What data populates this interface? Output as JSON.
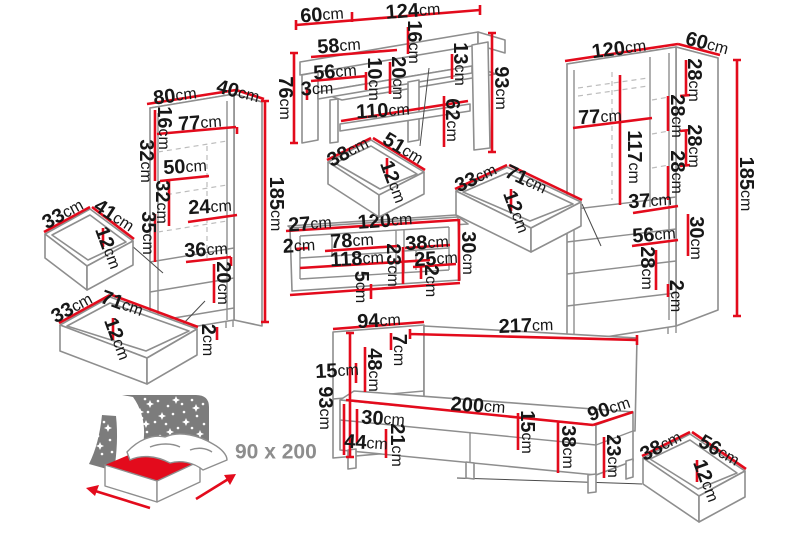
{
  "colors": {
    "dimension_red": "#e30b1c",
    "furniture_outline_gray": "#8e8e8e",
    "label_black": "#171717",
    "icon_panel_gray": "#7c7c7c",
    "icon_text_gray": "#8d8d8d"
  },
  "desk": {
    "dims": [
      {
        "v": "60",
        "u": "cm"
      },
      {
        "v": "124",
        "u": "cm"
      },
      {
        "v": "16",
        "u": "cm"
      },
      {
        "v": "58",
        "u": "cm"
      },
      {
        "v": "13",
        "u": "cm"
      },
      {
        "v": "56",
        "u": "cm"
      },
      {
        "v": "10",
        "u": "cm"
      },
      {
        "v": "20",
        "u": "cm"
      },
      {
        "v": "3",
        "u": "cm"
      },
      {
        "v": "76",
        "u": "cm"
      },
      {
        "v": "110",
        "u": "cm"
      },
      {
        "v": "62",
        "u": "cm"
      },
      {
        "v": "93",
        "u": "cm"
      }
    ]
  },
  "desk_drawer": {
    "dims": [
      {
        "v": "38",
        "u": "cm"
      },
      {
        "v": "51",
        "u": "cm"
      },
      {
        "v": "12",
        "u": "cm"
      }
    ]
  },
  "left_wardrobe": {
    "dims": [
      {
        "v": "80",
        "u": "cm"
      },
      {
        "v": "40",
        "u": "cm"
      },
      {
        "v": "16",
        "u": "cm"
      },
      {
        "v": "77",
        "u": "cm"
      },
      {
        "v": "32",
        "u": "cm"
      },
      {
        "v": "50",
        "u": "cm"
      },
      {
        "v": "32",
        "u": "cm"
      },
      {
        "v": "24",
        "u": "cm"
      },
      {
        "v": "35",
        "u": "cm"
      },
      {
        "v": "36",
        "u": "cm"
      },
      {
        "v": "20",
        "u": "cm"
      },
      {
        "v": "2",
        "u": "cm"
      },
      {
        "v": "185",
        "u": "cm"
      }
    ]
  },
  "left_drawer_top": {
    "dims": [
      {
        "v": "33",
        "u": "cm"
      },
      {
        "v": "41",
        "u": "cm"
      },
      {
        "v": "12",
        "u": "cm"
      }
    ]
  },
  "left_drawer_bottom": {
    "dims": [
      {
        "v": "33",
        "u": "cm"
      },
      {
        "v": "71",
        "u": "cm"
      },
      {
        "v": "12",
        "u": "cm"
      }
    ]
  },
  "wall_shelf": {
    "dims": [
      {
        "v": "27",
        "u": "cm"
      },
      {
        "v": "120",
        "u": "cm"
      },
      {
        "v": "2",
        "u": "cm"
      },
      {
        "v": "78",
        "u": "cm"
      },
      {
        "v": "38",
        "u": "cm"
      },
      {
        "v": "118",
        "u": "cm"
      },
      {
        "v": "25",
        "u": "cm"
      },
      {
        "v": "23",
        "u": "cm"
      },
      {
        "v": "5",
        "u": "cm"
      },
      {
        "v": "2",
        "u": "cm"
      },
      {
        "v": "30",
        "u": "cm"
      }
    ]
  },
  "middle_drawer": {
    "dims": [
      {
        "v": "33",
        "u": "cm"
      },
      {
        "v": "71",
        "u": "cm"
      },
      {
        "v": "12",
        "u": "cm"
      }
    ]
  },
  "right_wardrobe": {
    "dims": [
      {
        "v": "120",
        "u": "cm"
      },
      {
        "v": "60",
        "u": "cm"
      },
      {
        "v": "28",
        "u": "cm"
      },
      {
        "v": "77",
        "u": "cm"
      },
      {
        "v": "28",
        "u": "cm"
      },
      {
        "v": "28",
        "u": "cm"
      },
      {
        "v": "28",
        "u": "cm"
      },
      {
        "v": "117",
        "u": "cm"
      },
      {
        "v": "37",
        "u": "cm"
      },
      {
        "v": "56",
        "u": "cm"
      },
      {
        "v": "30",
        "u": "cm"
      },
      {
        "v": "28",
        "u": "cm"
      },
      {
        "v": "2",
        "u": "cm"
      },
      {
        "v": "185",
        "u": "cm"
      }
    ]
  },
  "bed": {
    "dims": [
      {
        "v": "94",
        "u": "cm"
      },
      {
        "v": "217",
        "u": "cm"
      },
      {
        "v": "7",
        "u": "cm"
      },
      {
        "v": "48",
        "u": "cm"
      },
      {
        "v": "15",
        "u": "cm"
      },
      {
        "v": "93",
        "u": "cm"
      },
      {
        "v": "200",
        "u": "cm"
      },
      {
        "v": "30",
        "u": "cm"
      },
      {
        "v": "44",
        "u": "cm"
      },
      {
        "v": "21",
        "u": "cm"
      },
      {
        "v": "15",
        "u": "cm"
      },
      {
        "v": "38",
        "u": "cm"
      },
      {
        "v": "90",
        "u": "cm"
      },
      {
        "v": "23",
        "u": "cm"
      }
    ]
  },
  "bottom_drawer": {
    "dims": [
      {
        "v": "38",
        "u": "cm"
      },
      {
        "v": "56",
        "u": "cm"
      },
      {
        "v": "12",
        "u": "cm"
      }
    ]
  },
  "bed_icon": {
    "label": "90 x 200"
  }
}
